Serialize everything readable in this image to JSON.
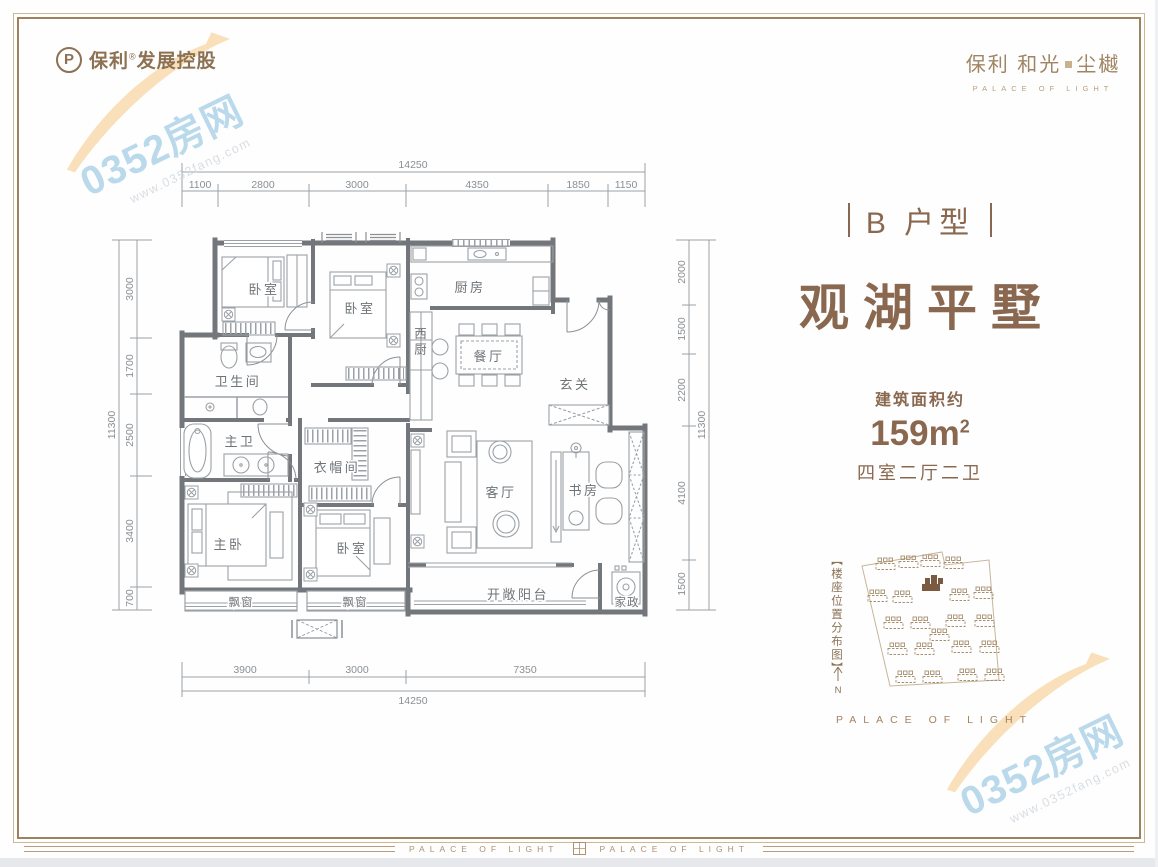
{
  "header": {
    "logo_mark": "P",
    "logo_brand": "保利",
    "logo_reg": "®",
    "logo_rest": "发展控股",
    "project_name_a": "保利 和光",
    "project_name_b": "尘樾",
    "project_sub": "PALACE OF LIGHT"
  },
  "info": {
    "unit_tag": "B 户型",
    "title": "观湖平墅",
    "area_label": "建筑面积约",
    "area_value": "159m",
    "area_sup": "2",
    "layout_desc": "四室二厅二卫"
  },
  "rooms": {
    "bedroom_a": "卧室",
    "bedroom_b": "卧室",
    "kitchen": "厨房",
    "west_kitchen": "西厨",
    "dining": "餐厅",
    "foyer": "玄关",
    "bathroom": "卫生间",
    "master_bath": "主卫",
    "cloakroom": "衣帽间",
    "master_bedroom": "主卧",
    "bedroom_c": "卧室",
    "living": "客厅",
    "study": "书房",
    "balcony": "开敞阳台",
    "laundry": "家政",
    "bay_window_a": "飘窗",
    "bay_window_b": "飘窗"
  },
  "dims": {
    "top": {
      "total": "14250",
      "segments": [
        "1100",
        "2800",
        "3000",
        "4350",
        "1850",
        "1150"
      ]
    },
    "bottom": {
      "total": "14250",
      "segments": [
        "3900",
        "3000",
        "7350"
      ]
    },
    "left": {
      "total": "11300",
      "segments": [
        "3000",
        "1700",
        "2500",
        "3400",
        "700"
      ]
    },
    "right": {
      "total": "11300",
      "segments": [
        "2000",
        "1500",
        "2200",
        "4100",
        "1500"
      ]
    }
  },
  "site_plan": {
    "label": "【楼座位置分布图】",
    "north_label": "N",
    "caption": "PALACE OF LIGHT"
  },
  "footer": {
    "brand_left": "PALACE OF LIGHT",
    "brand_right": "PALACE OF LIGHT"
  },
  "watermark": {
    "text": "0352房网",
    "url": "www.0352fang.com"
  },
  "colors": {
    "brand_brown": "#8a6850",
    "frame_gold": "#9d8260",
    "wall_gray": "#73777b",
    "watermark_blue": "#badaec",
    "highlight_building": "#7a5a40"
  }
}
